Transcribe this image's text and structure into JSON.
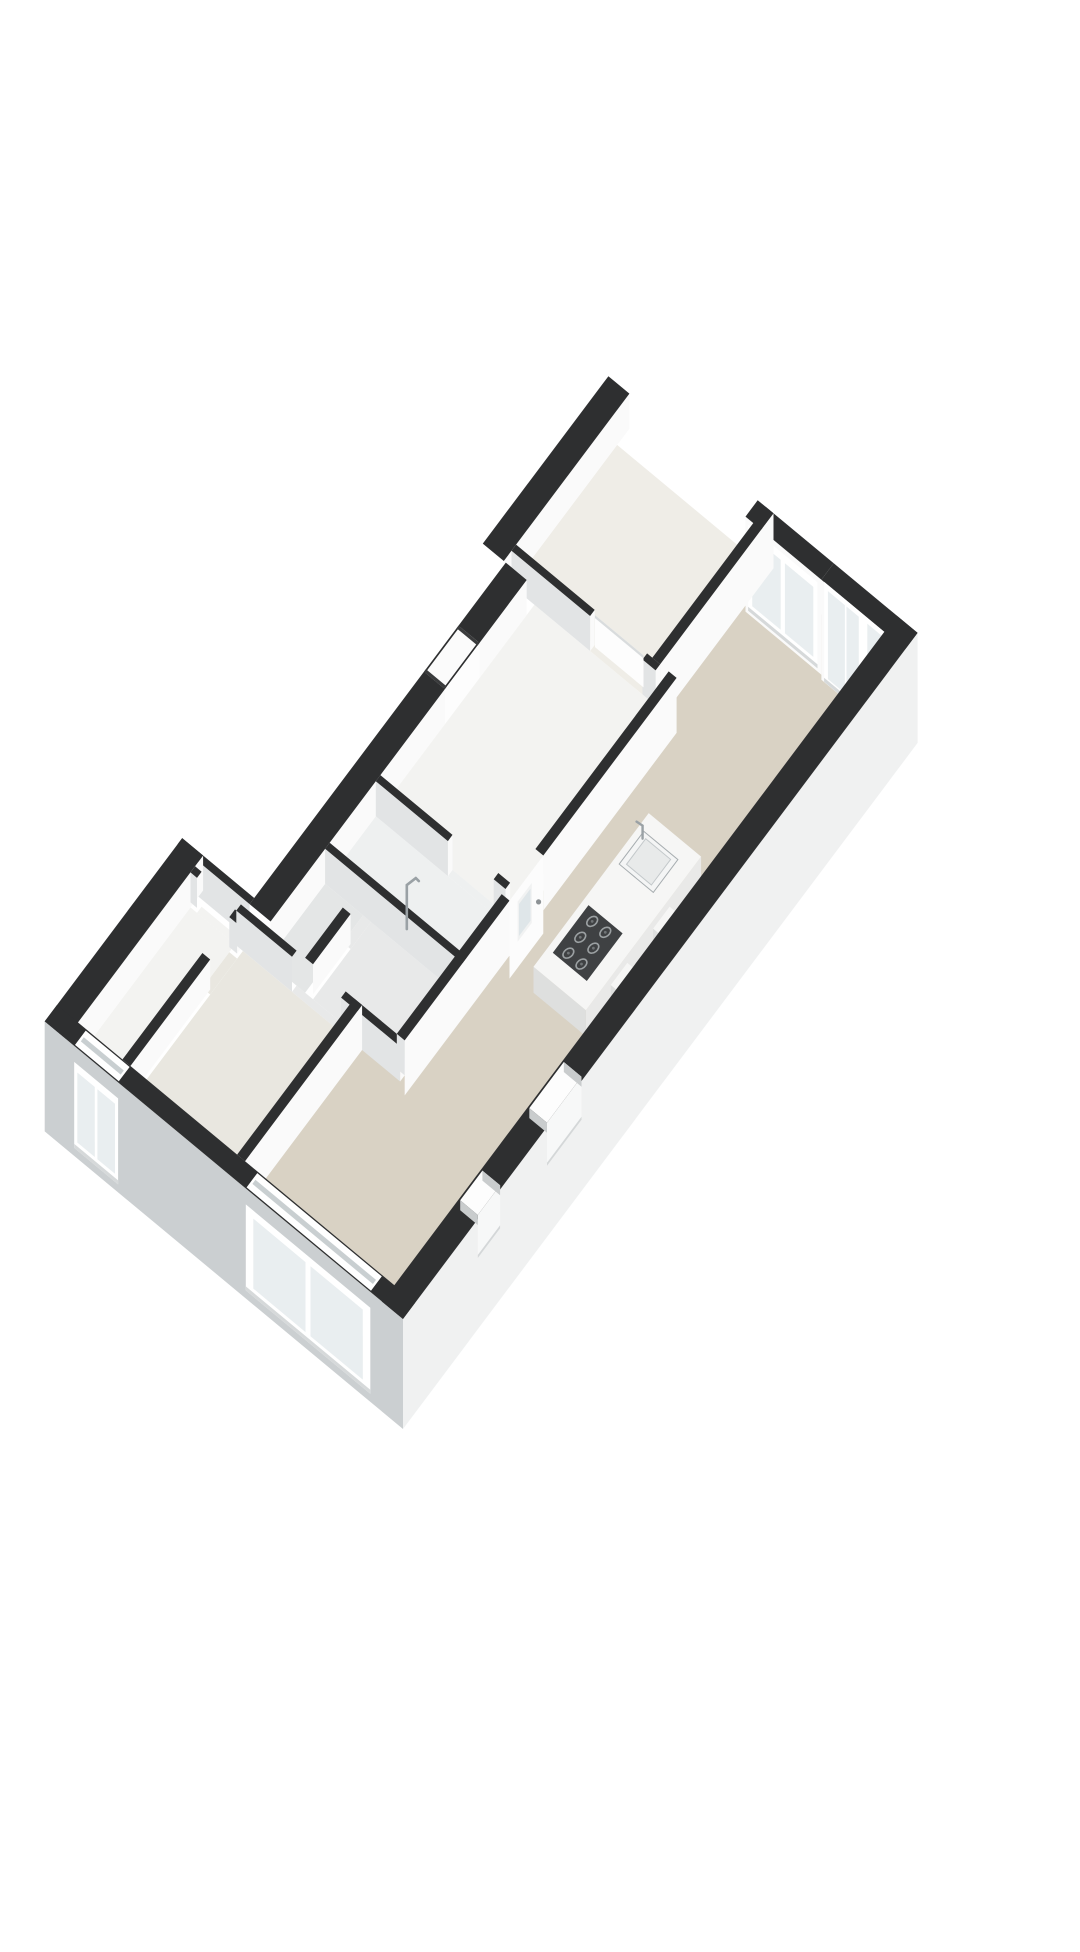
{
  "scene": {
    "label": "isometric-3d-floorplan",
    "background": "#ffffff",
    "canvas": {
      "w": 1080,
      "h": 1920
    }
  },
  "projection": {
    "ox": 363,
    "oy": 1303,
    "ax": 38.4,
    "ay": -51.2,
    "bx": -65.5,
    "by": -54.4,
    "floor_drop": 35
  },
  "palette": {
    "wallTop": "#2e2f30",
    "wallTopSoft": "#3a3b3c",
    "faceLit": "#fafafa",
    "faceShade": "#e2e4e5",
    "extSW": "#cbcfd1",
    "extSE": "#f0f1f1",
    "floorLiving": "#d9d2c4",
    "floorBed1": "#efede7",
    "floorBed2": "#e9e7e0",
    "floorHall": "#f3f3f1",
    "floorBath": "#eef0f0",
    "floorClosetA": "#e8e9e9",
    "floorClosetB": "#e4e6e6",
    "floorNarrow": "#ecteee-FIX",
    "glass": "#e9eef0",
    "glassDeep": "#dfe6e9",
    "frame": "#ffffff",
    "seam": "#c9cfd1",
    "sill": "#d6d9da",
    "islandTop": "#f6f6f5",
    "islandS": "#e9e9e8",
    "islandW": "#dedfde",
    "cooktop": "#3f4143",
    "burnerRing": "#9ba0a2",
    "burnerDot": "#707476",
    "steel": "#a7adb0",
    "chrome": "#9aa1a5"
  },
  "floors": [
    {
      "id": "living-room",
      "fill": "floorLiving",
      "poly": [
        [
          0.32,
          0.32
        ],
        [
          13.08,
          0.32
        ],
        [
          13.08,
          2.2
        ],
        [
          10.45,
          2.2
        ],
        [
          10.45,
          1.95
        ],
        [
          3.37,
          1.95
        ],
        [
          3.37,
          2.6
        ],
        [
          0.32,
          2.6
        ]
      ]
    },
    {
      "id": "bedroom-ne",
      "fill": "floorBed1",
      "poly": [
        [
          10.45,
          2.32
        ],
        [
          13.08,
          2.32
        ],
        [
          13.08,
          4.4
        ],
        [
          10.45,
          4.4
        ]
      ]
    },
    {
      "id": "bedroom-sw",
      "fill": "floorBed2",
      "poly": [
        [
          0.32,
          2.72
        ],
        [
          3.25,
          2.72
        ],
        [
          3.25,
          4.35
        ],
        [
          0.32,
          4.35
        ]
      ]
    },
    {
      "id": "narrow-room",
      "fill": "floorHall",
      "poly": [
        [
          0.32,
          4.47
        ],
        [
          3.25,
          4.47
        ],
        [
          3.25,
          5.15
        ],
        [
          0.32,
          5.15
        ]
      ]
    },
    {
      "id": "closet-a",
      "fill": "floorClosetA",
      "poly": [
        [
          3.37,
          2.07
        ],
        [
          4.88,
          2.07
        ],
        [
          4.88,
          3.35
        ],
        [
          3.37,
          3.35
        ]
      ]
    },
    {
      "id": "closet-b",
      "fill": "floorClosetB",
      "poly": [
        [
          3.37,
          3.47
        ],
        [
          4.88,
          3.47
        ],
        [
          4.88,
          4.05
        ],
        [
          3.37,
          4.05
        ]
      ]
    },
    {
      "id": "bathroom",
      "fill": "floorBath",
      "poly": [
        [
          5.0,
          2.07
        ],
        [
          6.2,
          2.07
        ],
        [
          6.2,
          4.05
        ],
        [
          5.0,
          4.05
        ]
      ]
    },
    {
      "id": "hallway",
      "fill": "floorHall",
      "poly": [
        [
          6.32,
          2.07
        ],
        [
          10.33,
          2.07
        ],
        [
          10.33,
          4.05
        ],
        [
          6.32,
          4.05
        ]
      ]
    },
    {
      "id": "threshold-entry",
      "fill": "floorLiving",
      "poly": [
        [
          6.1,
          1.95
        ],
        [
          6.98,
          1.95
        ],
        [
          6.98,
          2.07
        ],
        [
          6.1,
          2.07
        ]
      ]
    },
    {
      "id": "threshold-bed2",
      "fill": "floorClosetA",
      "poly": [
        [
          3.25,
          2.85
        ],
        [
          3.37,
          2.85
        ],
        [
          3.37,
          3.6
        ],
        [
          3.25,
          3.6
        ]
      ]
    },
    {
      "id": "threshold-narrow",
      "fill": "floorHall",
      "poly": [
        [
          3.25,
          4.45
        ],
        [
          3.37,
          4.45
        ],
        [
          3.37,
          5.05
        ],
        [
          3.25,
          5.05
        ]
      ]
    },
    {
      "id": "threshold-bed2-nw",
      "fill": "floorBed2",
      "poly": [
        [
          2.4,
          4.35
        ],
        [
          3.1,
          4.35
        ],
        [
          3.1,
          4.47
        ],
        [
          2.4,
          4.47
        ]
      ]
    },
    {
      "id": "threshold-closet",
      "fill": "floorClosetA",
      "poly": [
        [
          4.35,
          3.35
        ],
        [
          4.88,
          3.35
        ],
        [
          4.88,
          3.47
        ],
        [
          4.35,
          3.47
        ]
      ]
    },
    {
      "id": "threshold-bath",
      "fill": "floorBath",
      "poly": [
        [
          6.2,
          2.25
        ],
        [
          6.32,
          2.25
        ],
        [
          6.32,
          2.95
        ],
        [
          6.2,
          2.95
        ]
      ]
    },
    {
      "id": "threshold-bed1",
      "fill": "floorBed1",
      "poly": [
        [
          10.33,
          2.4
        ],
        [
          10.45,
          2.4
        ],
        [
          10.45,
          3.2
        ],
        [
          10.33,
          3.2
        ]
      ]
    }
  ],
  "items": [
    {
      "t": "wall",
      "id": "bedroom-nw-wall",
      "r": [
        10.13,
        4.4,
        13.4,
        4.72
      ],
      "s": 35,
      "w": 0
    },
    {
      "t": "wall",
      "id": "ne-window-wall",
      "r": [
        13.08,
        1.28,
        13.4,
        2.44
      ],
      "s": 35,
      "w": 95,
      "cw": "faceLit"
    },
    {
      "t": "wall",
      "id": "ne-glassdoor-wall",
      "r": [
        13.08,
        0.0,
        13.4,
        1.28
      ],
      "s": 0,
      "w": 100,
      "cw": "faceLit"
    },
    {
      "t": "facewin",
      "id": "ne-picture-window",
      "A": [
        13.08,
        2.4
      ],
      "B": [
        13.08,
        1.34
      ],
      "dzT": 6,
      "dzB": 92,
      "ins": 8,
      "panes": [
        [
          0.06,
          0.47
        ],
        [
          0.53,
          0.94
        ]
      ],
      "sill": true
    },
    {
      "t": "facewin",
      "id": "ne-sliding-glass-doors",
      "A": [
        13.08,
        1.24
      ],
      "B": [
        13.08,
        0.06
      ],
      "dzT": 0,
      "dzB": 100,
      "ins": 6,
      "panes": [
        [
          0.05,
          0.27
        ],
        [
          0.29,
          0.45
        ],
        [
          0.56,
          0.76
        ],
        [
          0.78,
          0.95
        ]
      ],
      "sill": true
    },
    {
      "t": "wall",
      "id": "bedroom1-se-wall",
      "r": [
        10.45,
        2.2,
        13.4,
        2.32
      ],
      "s": 55,
      "w": 0
    },
    {
      "t": "wall",
      "id": "bedroom1-sw-wall-a",
      "r": [
        10.33,
        2.2,
        10.45,
        2.4
      ],
      "s": 55,
      "w": 35
    },
    {
      "t": "wall",
      "id": "bedroom1-sw-wall-b",
      "r": [
        10.33,
        3.2,
        10.45,
        4.4
      ],
      "s": 35,
      "w": 35
    },
    {
      "t": "doorleaf",
      "id": "bedroom1-door",
      "A": [
        10.39,
        2.42
      ],
      "B": [
        10.39,
        3.16
      ],
      "dz": 32
    },
    {
      "t": "wall",
      "id": "nw-notch-wall",
      "r": [
        3.46,
        4.05,
        10.13,
        4.37
      ],
      "s": 35,
      "w": 0
    },
    {
      "t": "wall",
      "id": "nw-jog-wall",
      "r": [
        3.46,
        4.37,
        3.58,
        5.47
      ],
      "s": 0,
      "w": 35
    },
    {
      "t": "wall",
      "id": "nw-left-wall",
      "r": [
        0.0,
        5.15,
        3.58,
        5.47
      ],
      "s": 35,
      "w": 0
    },
    {
      "t": "wall",
      "id": "bath-e-wall-a",
      "r": [
        6.2,
        2.07,
        6.32,
        2.25
      ],
      "s": 35,
      "w": 35
    },
    {
      "t": "wall",
      "id": "bath-e-wall-b",
      "r": [
        6.2,
        2.95,
        6.32,
        4.05
      ],
      "s": 35,
      "w": 35
    },
    {
      "t": "wall",
      "id": "bath-w-wall",
      "r": [
        4.88,
        1.95,
        5.0,
        4.05
      ],
      "s": 35,
      "w": 35
    },
    {
      "t": "wall",
      "id": "closet-divider",
      "r": [
        3.37,
        3.35,
        4.35,
        3.47
      ],
      "s": 30,
      "w": 0
    },
    {
      "t": "wall",
      "id": "bed2-nw-wall-a",
      "r": [
        0.32,
        4.35,
        2.4,
        4.47
      ],
      "s": 30,
      "w": 0
    },
    {
      "t": "wall",
      "id": "bed2-nw-wall-b",
      "r": [
        3.1,
        4.35,
        3.25,
        4.47
      ],
      "s": 30,
      "w": 30
    },
    {
      "t": "wall",
      "id": "bed2-ne-wall-a",
      "r": [
        3.25,
        1.95,
        3.37,
        2.85
      ],
      "s": 35,
      "w": 35
    },
    {
      "t": "wall",
      "id": "bed2-ne-wall-b",
      "r": [
        3.25,
        3.6,
        3.37,
        4.45
      ],
      "s": 0,
      "w": 35
    },
    {
      "t": "wall",
      "id": "bed2-ne-wall-c",
      "r": [
        3.25,
        5.05,
        3.37,
        5.15
      ],
      "s": 0,
      "w": 30
    },
    {
      "t": "wall",
      "id": "living-nw-low-wall",
      "r": [
        0.32,
        2.6,
        3.37,
        2.72
      ],
      "s": 45,
      "w": 0
    },
    {
      "t": "wall",
      "id": "living-nw-wall-a",
      "r": [
        3.37,
        1.95,
        6.1,
        2.07
      ],
      "s": 55,
      "w": 35
    },
    {
      "t": "wall",
      "id": "living-nw-wall-b",
      "r": [
        6.98,
        1.95,
        10.45,
        2.07
      ],
      "s": 55,
      "w": 0
    },
    {
      "t": "glassdoor",
      "id": "entry-glass-door",
      "A": [
        6.1,
        1.95
      ],
      "B": [
        6.98,
        1.95
      ],
      "dz": 78,
      "pane": [
        0.28,
        0.62
      ],
      "pdzT": 16,
      "pdzB": 48,
      "handle": [
        0.86,
        40
      ]
    },
    {
      "t": "prism",
      "id": "kitchen-island",
      "r": [
        5.7,
        0.55,
        8.7,
        1.35
      ],
      "top": -22,
      "base": 4,
      "ct": "islandTop",
      "cs": "islandS",
      "cw": "islandW"
    },
    {
      "t": "cooktop",
      "id": "island-cooktop",
      "r": [
        6.05,
        0.74,
        6.98,
        1.26
      ],
      "top": -23,
      "cols": [
        6.2,
        6.51,
        6.82
      ],
      "rows": [
        0.91,
        1.11
      ]
    },
    {
      "t": "sink",
      "id": "island-sink",
      "r": [
        7.78,
        0.74,
        8.42,
        1.26
      ],
      "top": -23,
      "faucet": [
        8.32,
        1.22
      ]
    },
    {
      "t": "prism",
      "id": "stool-1",
      "r": [
        6.35,
        0.18,
        6.78,
        0.55
      ],
      "top": -14,
      "base": 2,
      "ct": "islandTop",
      "cs": "islandS",
      "cw": "islandW"
    },
    {
      "t": "prism",
      "id": "stool-2",
      "r": [
        7.45,
        0.18,
        7.88,
        0.55
      ],
      "top": -14,
      "base": 2,
      "ct": "islandTop",
      "cs": "islandS",
      "cw": "islandW"
    },
    {
      "t": "shower",
      "id": "shower-fixture",
      "at": [
        5.08,
        2.92
      ]
    },
    {
      "t": "wall",
      "id": "sw-exterior-wall",
      "r": [
        0.0,
        0.0,
        0.32,
        5.47
      ],
      "s": 0,
      "w": 110,
      "cw": "extSW"
    },
    {
      "t": "swwindow",
      "id": "living-sw-window",
      "b1": 0.5,
      "b2": 2.4,
      "dzT": 16,
      "dzB": 102,
      "panes": [
        [
          0.06,
          0.48
        ],
        [
          0.52,
          0.94
        ]
      ]
    },
    {
      "t": "swwindow",
      "id": "left-wing-sw-window",
      "b1": 4.35,
      "b2": 5.02,
      "dzT": 16,
      "dzB": 102,
      "panes": [
        [
          0.07,
          0.47
        ],
        [
          0.53,
          0.93
        ]
      ]
    },
    {
      "t": "wall",
      "id": "se-exterior-wall",
      "r": [
        0.0,
        0.0,
        13.4,
        0.32
      ],
      "s": 110,
      "w": 0,
      "cs": "extSE"
    },
    {
      "t": "niche",
      "id": "se-wall-niche-1",
      "a1": 2.0,
      "a2": 2.58
    },
    {
      "t": "niche",
      "id": "se-wall-niche-2",
      "a1": 3.8,
      "a2": 4.7
    },
    {
      "t": "doortop",
      "id": "front-door",
      "a1": 8.0,
      "a2": 8.9
    }
  ]
}
